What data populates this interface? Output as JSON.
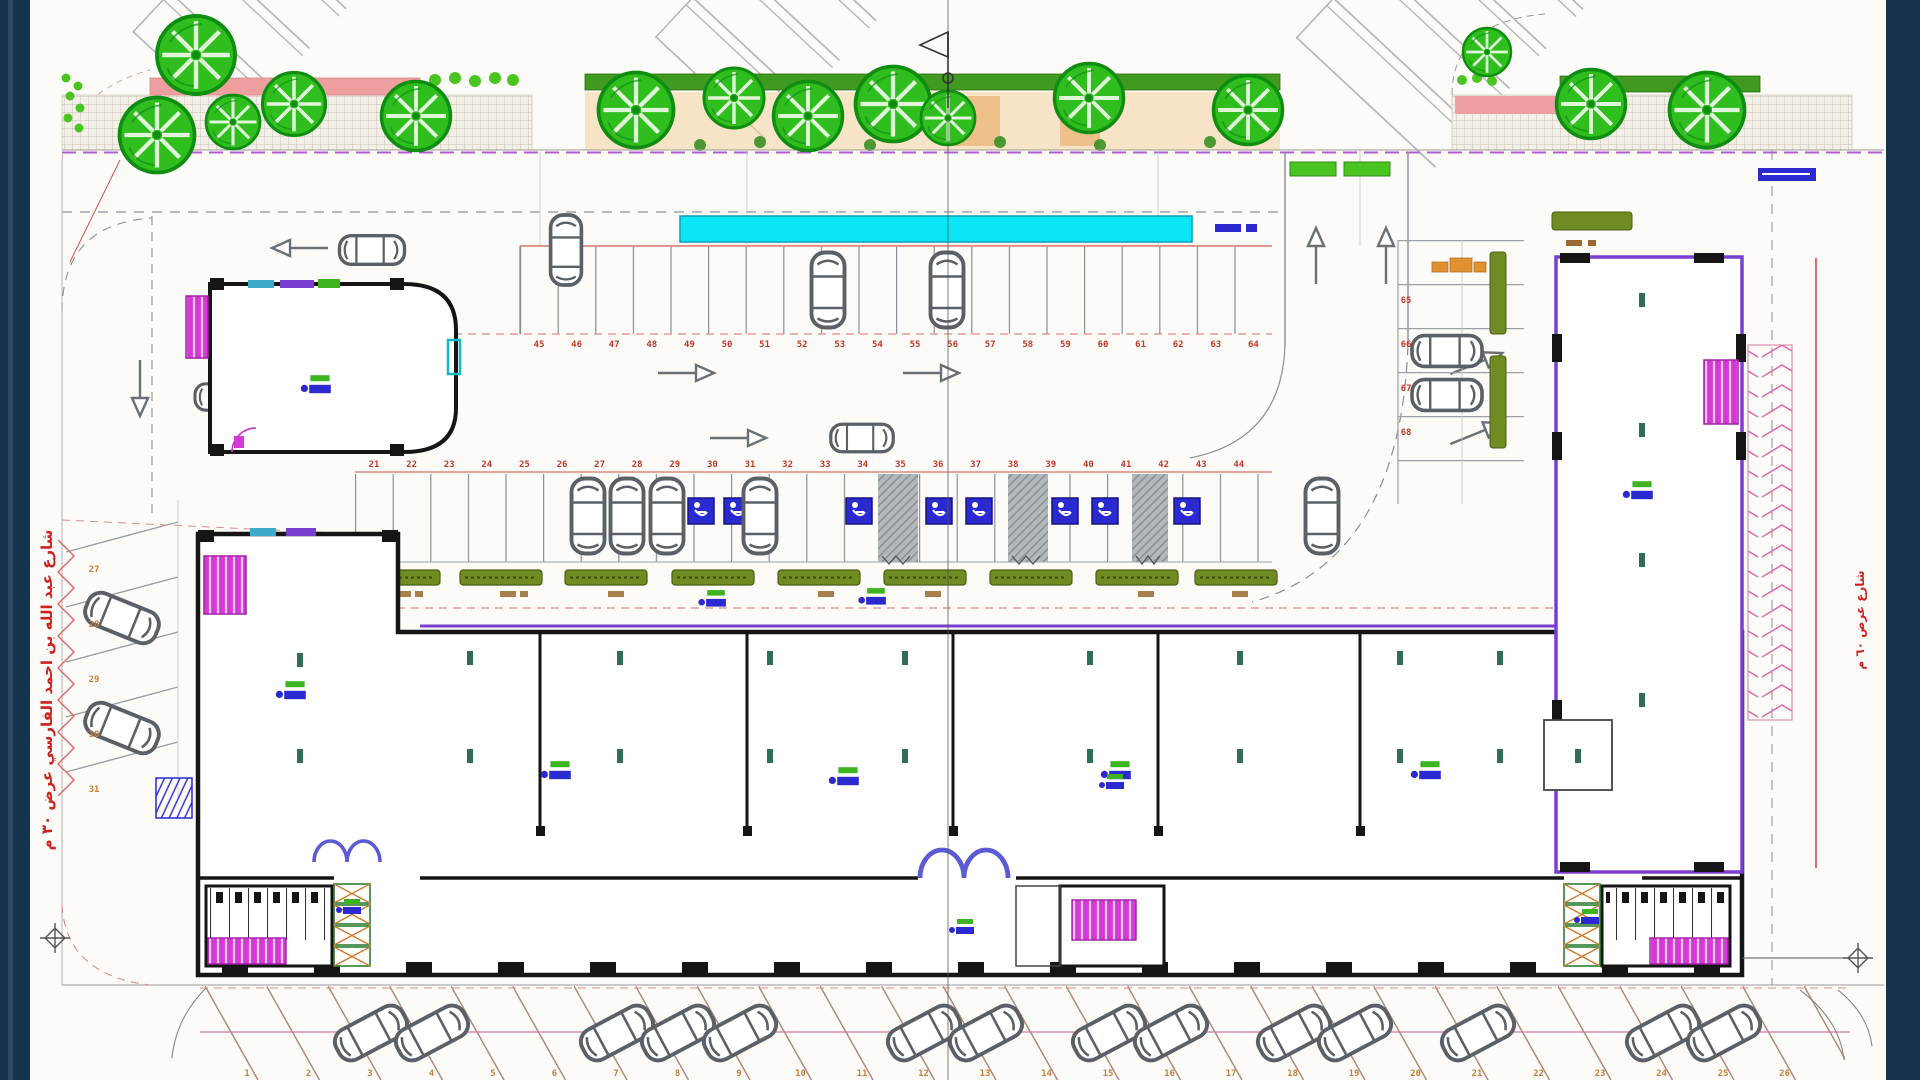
{
  "document": {
    "type": "architectural-site-plan",
    "sheet_name": "ground-floor-site-plan"
  },
  "streets": {
    "left_label": "شارع عبد الله بن احمد الفارسي عرض ٣٠ م",
    "right_label": "شارع عرض ٦٠ م"
  },
  "colors": {
    "background_navy": "#16334e",
    "paper": "#fcfbf8",
    "tree_green": "#2fbe1e",
    "hedge_olive": "#6f8b21",
    "stair_magenta": "#d43ad4",
    "boundary_purple": "#7a3fd1",
    "canopy_cyan": "#0ae6f6",
    "accessible_blue": "#2a2ad0",
    "stall_number_red": "#c0392b",
    "stall_number_orange": "#c77f3a",
    "wall_black": "#151515",
    "dashed_pink": "#e08a8a"
  },
  "parking": {
    "top_row": {
      "count": 20,
      "numbers": [
        "45",
        "46",
        "47",
        "48",
        "49",
        "50",
        "51",
        "52",
        "53",
        "54",
        "55",
        "56",
        "57",
        "58",
        "59",
        "60",
        "61",
        "62",
        "63",
        "64"
      ]
    },
    "middle_row": {
      "count": 24,
      "accessible_stalls": 8,
      "numbers": [
        "21",
        "22",
        "23",
        "24",
        "25",
        "26",
        "27",
        "28",
        "29",
        "30",
        "31",
        "32",
        "33",
        "34",
        "35",
        "36",
        "37",
        "38",
        "39",
        "40",
        "41",
        "42",
        "43",
        "44"
      ]
    },
    "bottom_row": {
      "count": 26,
      "numbers": [
        "1",
        "2",
        "3",
        "4",
        "5",
        "6",
        "7",
        "8",
        "9",
        "10",
        "11",
        "12",
        "13",
        "14",
        "15",
        "16",
        "17",
        "18",
        "19",
        "20",
        "21",
        "22",
        "23",
        "24",
        "25",
        "26"
      ]
    },
    "left_column": {
      "count": 5,
      "numbers": [
        "27",
        "28",
        "29",
        "30",
        "31"
      ]
    },
    "right_column": {
      "count": 4,
      "numbers": [
        "65",
        "66",
        "67",
        "68"
      ]
    }
  },
  "landscape": {
    "tree_count": 15
  }
}
